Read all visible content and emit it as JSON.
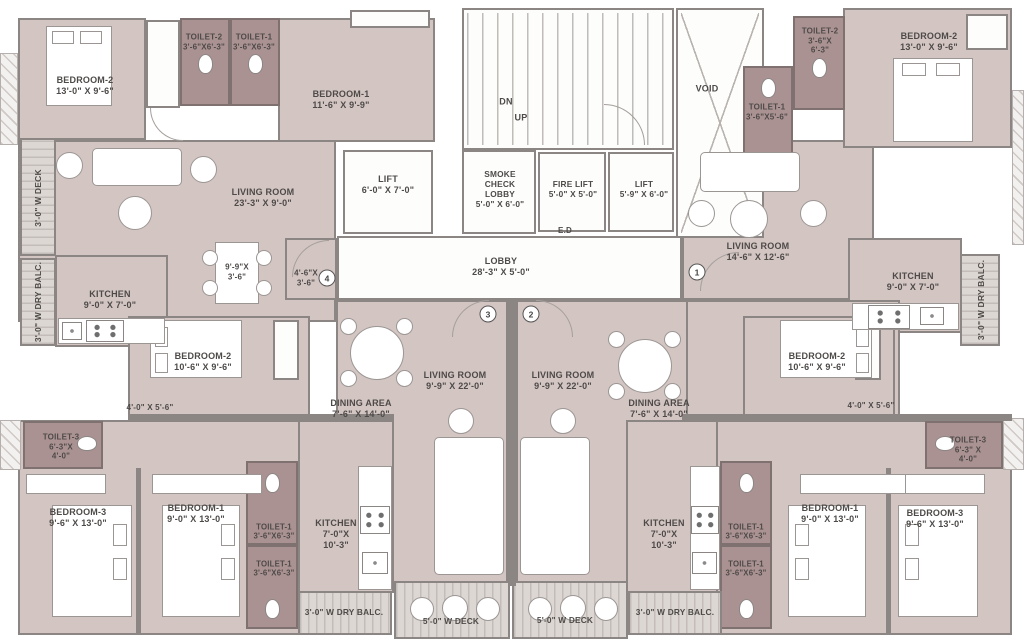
{
  "core": {
    "dn": "DN",
    "up": "UP",
    "smoke_check_lobby": "SMOKE\nCHECK\nLOBBY\n5'-0\" X 6'-0\"",
    "fire_lift": "FIRE LIFT\n5'-0\" X 5'-0\"",
    "lift": "LIFT\n5'-9\" X 6'-0\"",
    "ed": "E.D",
    "void": "VOID",
    "lobby": "LOBBY\n28'-3\" X 5'-0\""
  },
  "unit4": {
    "number": "4",
    "bedroom2": "BEDROOM-2\n13'-0\" X 9'-6\"",
    "toilet2": "TOILET-2\n3'-6\"X6'-3\"",
    "toilet1": "TOILET-1\n3'-6\"X6'-3\"",
    "bedroom1": "BEDROOM-1\n11'-6\" X 9'-9\"",
    "living_room": "LIVING ROOM\n23'-3\" X 9'-0\"",
    "lift": "LIFT\n6'-0\" X 7'-0\"",
    "kitchen": "KITCHEN\n9'-0\" X 7'-0\"",
    "dining_table": "9'-9\"X\n3'-6\"",
    "foyer": "4'-6\"X\n3'-6\"",
    "bedroom2b": "BEDROOM-2\n10'-6\" X 9'-6\"",
    "passage": "4'-0\" X 5'-6\"",
    "deck": "3'-0\" W DECK",
    "dry_balcony": "3'-0\" W DRY BALC."
  },
  "unit1": {
    "number": "1",
    "toilet2": "TOILET-2\n3'-6\"X\n6'-3\"",
    "toilet1": "TOILET-1\n3'-6\"X5'-6\"",
    "bedroom2": "BEDROOM-2\n13'-0\" X 9'-6\"",
    "living_room": "LIVING ROOM\n14'-6\" X 12'-6\"",
    "kitchen": "KITCHEN\n9'-0\" X 7'-0\"",
    "bedroom2b": "BEDROOM-2\n10'-6\" X 9'-6\"",
    "passage": "4'-0\" X 5'-6\"",
    "dry_balcony": "3'-0\" W DRY BALC."
  },
  "unit3": {
    "number": "3",
    "living_room": "LIVING ROOM\n9'-9\" X 22'-0\"",
    "dining_area": "DINING AREA\n7'-6\" X 14'-0\"",
    "bedroom3": "BEDROOM-3\n9'-6\" X 13'-0\"",
    "bedroom1": "BEDROOM-1\n9'-0\" X 13'-0\"",
    "toilet3": "TOILET-3\n6'-3\"X\n4'-0\"",
    "toilet1a": "TOILET-1\n3'-6\"X6'-3\"",
    "toilet1b": "TOILET-1\n3'-6\"X6'-3\"",
    "kitchen": "KITCHEN\n7'-0\"X\n10'-3\"",
    "dry_balcony": "3'-0\" W DRY BALC.",
    "deck": "5'-0\" W DECK"
  },
  "unit2": {
    "number": "2",
    "living_room": "LIVING ROOM\n9'-9\" X 22'-0\"",
    "dining_area": "DINING AREA\n7'-6\" X 14'-0\"",
    "bedroom1": "BEDROOM-1\n9'-0\" X 13'-0\"",
    "bedroom3": "BEDROOM-3\n9'-6\" X 13'-0\"",
    "toilet3": "TOILET-3\n6'-3\" X\n4'-0\"",
    "toilet1a": "TOILET-1\n3'-6\"X6'-3\"",
    "toilet1b": "TOILET-1\n3'-6\"X6'-3\"",
    "kitchen": "KITCHEN\n7'-0\"X\n10'-3\"",
    "deck": "5'-0\" W DECK",
    "dry_balcony": "3'-0\" W DRY BALC."
  }
}
